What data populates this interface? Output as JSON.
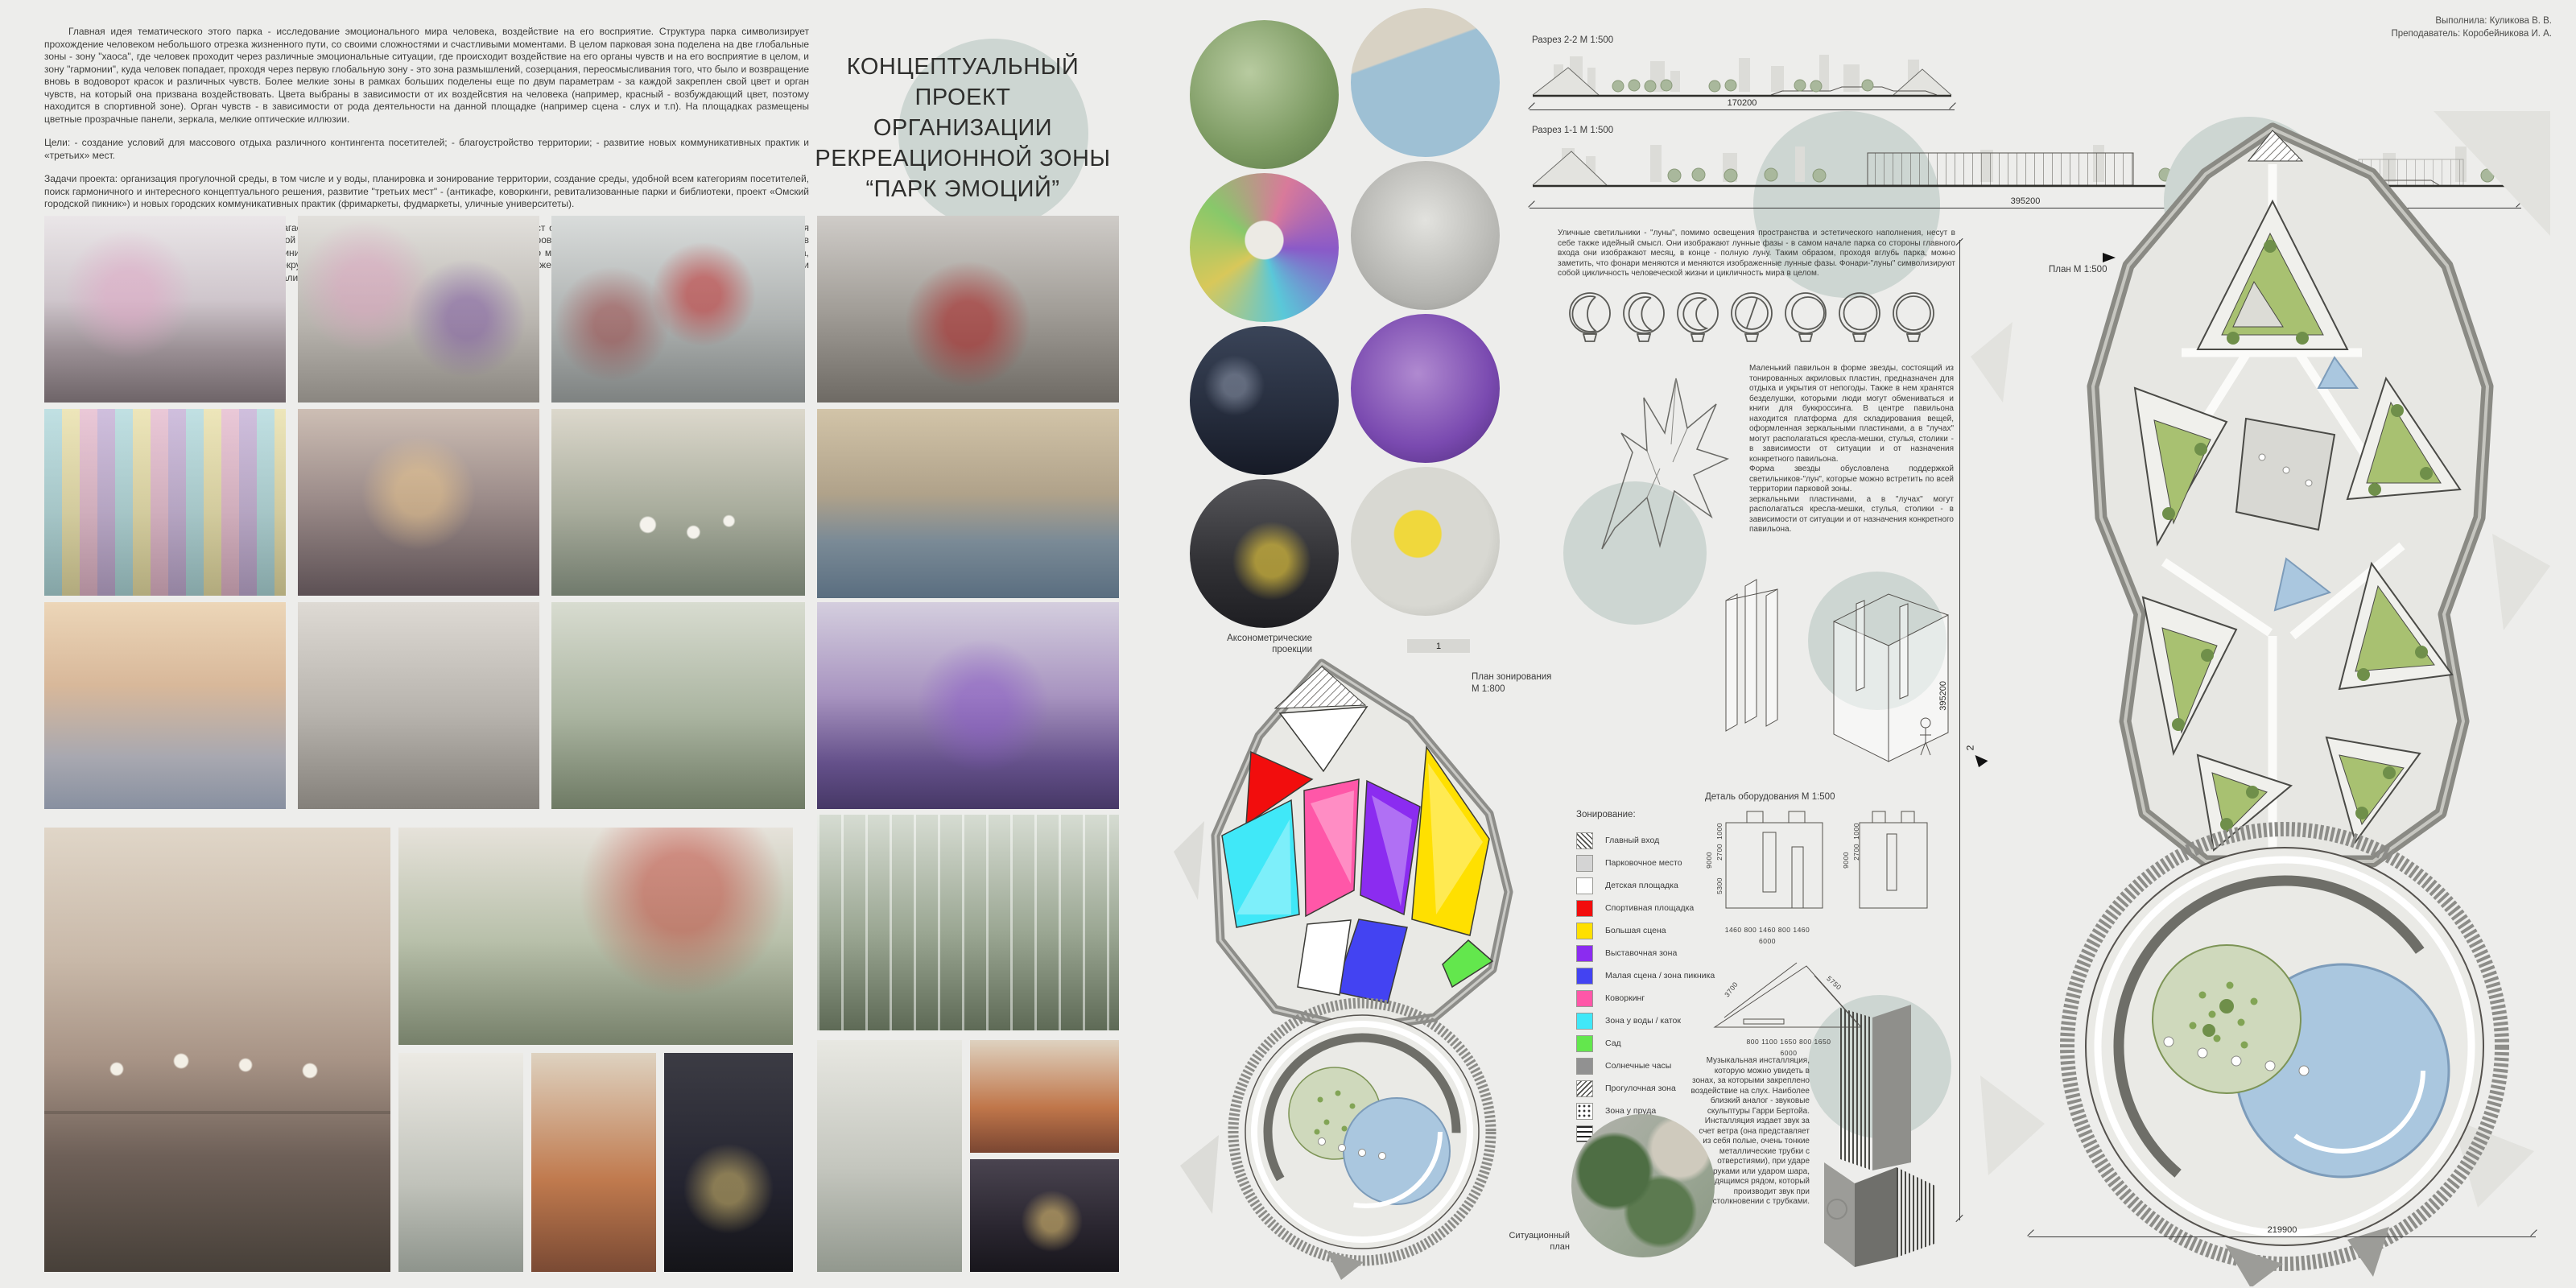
{
  "board": {
    "background": "#ededeb",
    "accent_circle": "#cdd6d2"
  },
  "credits": {
    "line1": "Выполнила: Куликова В. В.",
    "line2": "Преподаватель: Коробейникова И. А."
  },
  "title": {
    "lines": [
      "КОНЦЕПТУАЛЬНЫЙ ПРОЕКТ",
      "ОРГАНИЗАЦИИ",
      "РЕКРЕАЦИОННОЙ ЗОНЫ",
      "“ПАРК ЭМОЦИЙ”"
    ]
  },
  "intro": {
    "p1": "Главная идея тематического этого парка - исследование эмоционального мира человека, воздействие на его восприятие. Структура парка символизирует прохождение человеком небольшого отрезка жизненного пути, со своими сложностями и счастливыми моментами. В целом парковая зона поделена на две глобальные зоны - зону \"хаоса\", где человек проходит через различные эмоциональные ситуации, где происходит воздействие на его органы чувств и на его восприятие в целом, и зону \"гармонии\", куда человек попадает, проходя через первую глобальную зону - это зона размышлений, созерцания, переосмысливания того, что было и возвращение вновь в водоворот красок и различных чувств. Более мелкие зоны в рамках больших поделены еще по двум параметрам - за каждой закреплен свой цвет и орган чувств, на который она призвана воздействовать. Цвета выбраны в зависимости от их воздейсвтия на человека (например, красный - возбуждающий цвет, поэтому находится в спортивной зоне). Орган чувств - в зависимости от рода деятельности на данной площадке (например сцена - слух и т.п).  На площадках размещены цветные прозрачные панели, зеркала, мелкие оптические иллюзии.",
    "goals": "Цели: - создание условий для массового отдыха различного контингента посетителей; - благоустройство территории; - развитие новых коммуникативных практик и «третьих» мест.",
    "tasks": "Задачи проекта: организация прогулочной среды, в том числе и у воды, планировка и зонирование территории, создание среды, удобной всем категориям посетителей, поиск гармоничного и интересного концептуального решения, развитие \"третьих мест\" - (антикафе, коворкинги,  ревитализованные парки и библиотеки, проект «Омский городской пикник») и новых городских коммуникативных практик (фримаркеты, фудмаркеты, уличные университеты).",
    "p3": "Для решения проблематики территории предлагается новая схема зонирования. Благоустройство мест отдыха, организация специальных мест для проведения пикников, развлечения на открытом воздухе. Основной эстетической наполняющей является цветовое зонирование и иллюзорность некоторых объектов (арт-объектов и МАФ), игра отражений в сочетании с несколько минималистическим стилем в целом. Преполагается, что местность будет меняться благодаря посетителям парка, которые могут вносить свой вклад во внешний вид окружения - рисовать, украшать объекты и т.п. Парк должен быть максимально дружелюбен к посетителям, но при этом удерживать их от засорения территории и вандализма."
  },
  "sections": {
    "s22": {
      "label": "Разрез 2-2 М 1:500",
      "dim": "170200"
    },
    "s11": {
      "label": "Разрез 1-1 М 1:500",
      "dim": "395200"
    }
  },
  "axon": {
    "label1": "Аксонометрические",
    "label2": "проекции"
  },
  "zoning_plan": {
    "label1": "План зонирования",
    "label2": "М 1:800"
  },
  "lamps": {
    "text": "Уличные светильники - \"луны\", помимо освещения пространства и эстетического наполнения, несут в себе также идейный смысл. Они изображают лунные фазы - в самом начале парка со стороны главного входа они изображают месяц, в конце - полную луну. Таким образом, проходя вглубь парка, можно заметить, что фонари меняются и меняются изображенные лунные фазы. Фонари-\"луны\" символизируют собой цикличность человеческой жизни и цикличность мира в целом."
  },
  "pavilion": {
    "text1": "Маленький павильон в форме звезды, состоящий из тонированных акриловых пластин, предназначен для отдыха и укрытия от непогоды. Также в нем хранятся безделушки, которыми люди могут обмениваться и книги для буккроссинга. В центре павильона находится платформа для складирования вещей, оформленная зеркальными пластинами, а в \"лучах\" могут располагаться кресла-мешки, стулья, столики - в зависимости от ситуации и от назначения конкретного павильона.",
    "text2": "Форма звезды обусловлена поддержкой светильников-\"лун\", которые можно встретить по всей территории парковой зоны.",
    "text3": "зеркальными пластинами, а в \"лучах\" могут располагаться кресла-мешки, стулья, столики - в зависимости от ситуации и от назначения конкретного павильона."
  },
  "equipment_detail": {
    "label": "Деталь оборудования М 1:500"
  },
  "legend": {
    "title": "Зонирование:",
    "items": [
      {
        "label": "Главный вход",
        "swatch": "hatch-diagonal-left"
      },
      {
        "label": "Парковочное место",
        "color": "#d4d4d4"
      },
      {
        "label": "Детская площадка",
        "color": "#ffffff"
      },
      {
        "label": "Спортивная площадка",
        "color": "#f20d0d"
      },
      {
        "label": "Большая сцена",
        "color": "#ffe000"
      },
      {
        "label": "Выставочная зона",
        "color": "#8b2cf0"
      },
      {
        "label": "Малая сцена / зона пикника",
        "color": "#4343f2"
      },
      {
        "label": "Коворкинг",
        "color": "#ff57a8"
      },
      {
        "label": "Зона у воды / каток",
        "color": "#40e8f8"
      },
      {
        "label": "Сад",
        "color": "#63e74d"
      },
      {
        "label": "Солнечные часы",
        "color": "#919191"
      },
      {
        "label": "Прогулочная зона",
        "swatch": "hatch-diagonal-right"
      },
      {
        "label": "Зона у пруда",
        "swatch": "dots"
      },
      {
        "label": "Смотровая площадка",
        "swatch": "horizontal-lines"
      }
    ]
  },
  "detail_dims": {
    "elevation": {
      "h1": "1000",
      "h2": "2700",
      "h3": "5300",
      "total_h": "9000",
      "bottom": "1460  800  1460  800  1460",
      "bottom_total": "6000"
    },
    "triangle": {
      "left": "3700",
      "right": "5750",
      "bottom": "800  1100  1650  800  1650",
      "bottom_total": "6000"
    }
  },
  "music": {
    "text": "Музыкальная инсталляция, которую можно увидеть в зонах, за которыми закреплено воздействие на слух. Наиболее близкий аналог - звуковые скульптуры Гарри Бертойа. Инсталляция издает звук за счет ветра (она представляет из себя полые, очень тонкие металлические трубки с отверстиями), при ударе руками или ударом шара, находящимся рядом, который производит звук при столкновении с трубками."
  },
  "situational_plan": {
    "label1": "Ситуационный",
    "label2": "план"
  },
  "master_plan": {
    "label": "План М 1:500",
    "dim_vertical": "395200",
    "dim_horizontal": "219900",
    "marker1": "1",
    "marker2": "2"
  }
}
